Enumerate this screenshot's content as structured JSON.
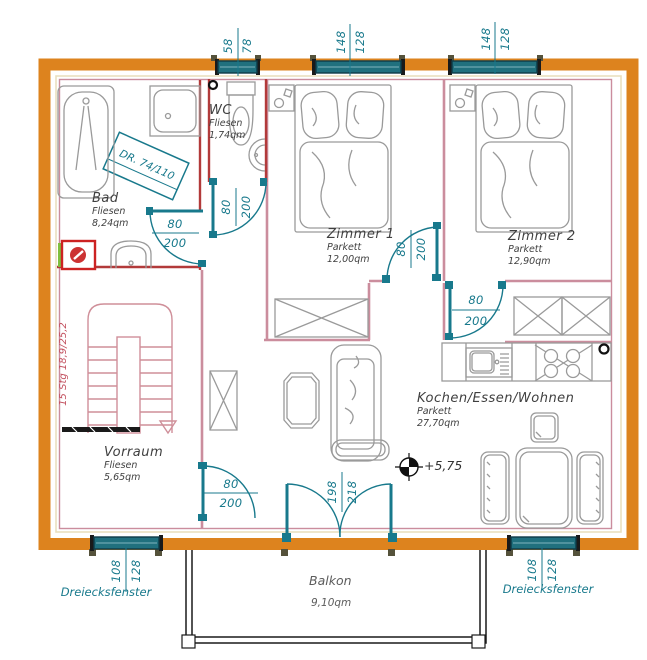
{
  "rooms": {
    "wc": {
      "name": "WC",
      "floor": "Fliesen",
      "area": "1,74qm"
    },
    "bad": {
      "name": "Bad",
      "floor": "Fliesen",
      "area": "8,24qm"
    },
    "zimmer1": {
      "name": "Zimmer 1",
      "floor": "Parkett",
      "area": "12,00qm"
    },
    "zimmer2": {
      "name": "Zimmer 2",
      "floor": "Parkett",
      "area": "12,90qm"
    },
    "vorraum": {
      "name": "Vorraum",
      "floor": "Fliesen",
      "area": "5,65qm"
    },
    "wohnen": {
      "name": "Kochen/Essen/Wohnen",
      "floor": "Parkett",
      "area": "27,70qm"
    },
    "balkon": {
      "name": "Balkon",
      "area": "9,10qm"
    }
  },
  "dims": {
    "window_wc": {
      "a": "58",
      "b": "78"
    },
    "window_zimmer1": {
      "a": "148",
      "b": "128"
    },
    "window_zimmer2": {
      "a": "148",
      "b": "128"
    },
    "window_bottom_left": {
      "a": "108",
      "b": "128"
    },
    "window_bottom_right": {
      "a": "108",
      "b": "128"
    },
    "door_bad": {
      "a": "80",
      "b": "200"
    },
    "door_wc": {
      "a": "80",
      "b": "200"
    },
    "door_zimmer1": {
      "a": "80",
      "b": "200"
    },
    "door_zimmer2": {
      "a": "80",
      "b": "200"
    },
    "door_vorraum": {
      "a": "80",
      "b": "200"
    },
    "door_balkon": {
      "a": "198",
      "b": "218"
    }
  },
  "annotations": {
    "skylight": "DR. 74/110",
    "stairs": "15 Stg 18,9/25,2",
    "elevation": "+5,75",
    "triangle_left": "Dreiecksfenster",
    "triangle_right": "Dreiecksfenster"
  },
  "colors": {
    "wall_orange": "#DD831E",
    "teal": "#18798C",
    "pink_wall": "#CB8D9D",
    "red_wall": "#B23A3A",
    "furniture_gray": "#9A9A9A"
  }
}
